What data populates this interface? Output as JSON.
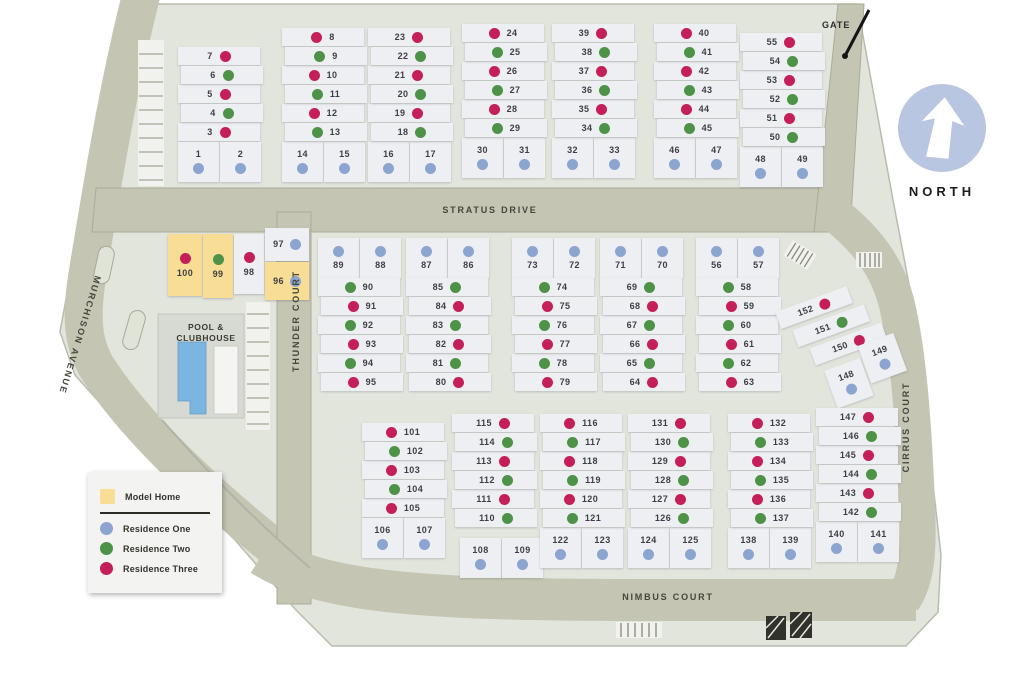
{
  "colors": {
    "1": "#8ba4d0",
    "2": "#4e9247",
    "3": "#c51f5a",
    "model": "#f8dd94",
    "road": "#c5c5b3",
    "map_bg": "#e2e5dc",
    "lot_bg": "#edeff2",
    "pool_water": "#7cb6e0",
    "north_badge": "#b9c6e1"
  },
  "labels": {
    "north": "NORTH",
    "gate": "GATE",
    "pool_line1": "POOL &",
    "pool_line2": "CLUBHOUSE"
  },
  "streets": {
    "stratus": "STRATUS DRIVE",
    "thunder": "THUNDER COURT",
    "murchison": "MURCHISON AVENUE",
    "nimbus": "NIMBUS COURT",
    "cirrus": "CIRRUS COURT"
  },
  "legend": {
    "model_home": "Model Home",
    "residence_one": "Residence One",
    "residence_two": "Residence Two",
    "residence_three": "Residence Three"
  },
  "clusters": [
    {
      "kind": "stack",
      "x": 178,
      "y": 47,
      "dot": "right",
      "pair_pos": "bottom",
      "rows": [
        [
          "7",
          "3"
        ],
        [
          "6",
          "2"
        ],
        [
          "5",
          "3"
        ],
        [
          "4",
          "2"
        ],
        [
          "3",
          "3"
        ]
      ],
      "pair": [
        [
          "1",
          "1"
        ],
        [
          "2",
          "1"
        ]
      ]
    },
    {
      "kind": "stack",
      "x": 282,
      "y": 28,
      "dot": "left",
      "pair_pos": "bottom",
      "rows": [
        [
          "8",
          "3"
        ],
        [
          "9",
          "2"
        ],
        [
          "10",
          "3"
        ],
        [
          "11",
          "2"
        ],
        [
          "12",
          "3"
        ],
        [
          "13",
          "2"
        ]
      ],
      "pair": [
        [
          "14",
          "1"
        ],
        [
          "15",
          "1"
        ]
      ]
    },
    {
      "kind": "stack",
      "x": 368,
      "y": 28,
      "dot": "right",
      "pair_pos": "bottom",
      "rows": [
        [
          "23",
          "3"
        ],
        [
          "22",
          "2"
        ],
        [
          "21",
          "3"
        ],
        [
          "20",
          "2"
        ],
        [
          "19",
          "3"
        ],
        [
          "18",
          "2"
        ]
      ],
      "pair": [
        [
          "16",
          "1"
        ],
        [
          "17",
          "1"
        ]
      ]
    },
    {
      "kind": "stack",
      "x": 462,
      "y": 24,
      "dot": "left",
      "pair_pos": "bottom",
      "rows": [
        [
          "24",
          "3"
        ],
        [
          "25",
          "2"
        ],
        [
          "26",
          "3"
        ],
        [
          "27",
          "2"
        ],
        [
          "28",
          "3"
        ],
        [
          "29",
          "2"
        ]
      ],
      "pair": [
        [
          "30",
          "1"
        ],
        [
          "31",
          "1"
        ]
      ]
    },
    {
      "kind": "stack",
      "x": 552,
      "y": 24,
      "dot": "right",
      "pair_pos": "bottom",
      "rows": [
        [
          "39",
          "3"
        ],
        [
          "38",
          "2"
        ],
        [
          "37",
          "3"
        ],
        [
          "36",
          "2"
        ],
        [
          "35",
          "3"
        ],
        [
          "34",
          "2"
        ]
      ],
      "pair": [
        [
          "32",
          "1"
        ],
        [
          "33",
          "1"
        ]
      ]
    },
    {
      "kind": "stack",
      "x": 654,
      "y": 24,
      "dot": "left",
      "pair_pos": "bottom",
      "rows": [
        [
          "40",
          "3"
        ],
        [
          "41",
          "2"
        ],
        [
          "42",
          "3"
        ],
        [
          "43",
          "2"
        ],
        [
          "44",
          "3"
        ],
        [
          "45",
          "2"
        ]
      ],
      "pair": [
        [
          "46",
          "1"
        ],
        [
          "47",
          "1"
        ]
      ]
    },
    {
      "kind": "stack",
      "x": 740,
      "y": 33,
      "dot": "right",
      "pair_pos": "bottom",
      "rows": [
        [
          "55",
          "3"
        ],
        [
          "54",
          "2"
        ],
        [
          "53",
          "3"
        ],
        [
          "52",
          "2"
        ],
        [
          "51",
          "3"
        ],
        [
          "50",
          "2"
        ]
      ],
      "pair": [
        [
          "48",
          "1"
        ],
        [
          "49",
          "1"
        ]
      ]
    },
    {
      "kind": "model",
      "x": 168,
      "y": 228,
      "cells": [
        [
          "100",
          "3",
          true
        ],
        [
          "99",
          "2",
          true
        ],
        [
          "98",
          "3",
          false
        ],
        [
          "97",
          "1",
          false
        ],
        [
          "96",
          "1",
          true
        ]
      ]
    },
    {
      "kind": "stack",
      "x": 318,
      "y": 238,
      "dot": "left",
      "pair_pos": "top",
      "rows": [
        [
          "90",
          "2"
        ],
        [
          "91",
          "3"
        ],
        [
          "92",
          "2"
        ],
        [
          "93",
          "3"
        ],
        [
          "94",
          "2"
        ],
        [
          "95",
          "3"
        ]
      ],
      "pair": [
        [
          "89",
          "1"
        ],
        [
          "88",
          "1"
        ]
      ]
    },
    {
      "kind": "stack",
      "x": 406,
      "y": 238,
      "dot": "right",
      "pair_pos": "top",
      "rows": [
        [
          "85",
          "2"
        ],
        [
          "84",
          "3"
        ],
        [
          "83",
          "2"
        ],
        [
          "82",
          "3"
        ],
        [
          "81",
          "2"
        ],
        [
          "80",
          "3"
        ]
      ],
      "pair": [
        [
          "87",
          "1"
        ],
        [
          "86",
          "1"
        ]
      ]
    },
    {
      "kind": "stack",
      "x": 512,
      "y": 238,
      "dot": "left",
      "pair_pos": "top",
      "rows": [
        [
          "74",
          "2"
        ],
        [
          "75",
          "3"
        ],
        [
          "76",
          "2"
        ],
        [
          "77",
          "3"
        ],
        [
          "78",
          "2"
        ],
        [
          "79",
          "3"
        ]
      ],
      "pair": [
        [
          "73",
          "1"
        ],
        [
          "72",
          "1"
        ]
      ]
    },
    {
      "kind": "stack",
      "x": 600,
      "y": 238,
      "dot": "right",
      "pair_pos": "top",
      "rows": [
        [
          "69",
          "2"
        ],
        [
          "68",
          "3"
        ],
        [
          "67",
          "2"
        ],
        [
          "66",
          "3"
        ],
        [
          "65",
          "2"
        ],
        [
          "64",
          "3"
        ]
      ],
      "pair": [
        [
          "71",
          "1"
        ],
        [
          "70",
          "1"
        ]
      ]
    },
    {
      "kind": "stack",
      "x": 696,
      "y": 238,
      "dot": "left",
      "pair_pos": "top",
      "rows": [
        [
          "58",
          "2"
        ],
        [
          "59",
          "3"
        ],
        [
          "60",
          "2"
        ],
        [
          "61",
          "3"
        ],
        [
          "62",
          "2"
        ],
        [
          "63",
          "3"
        ]
      ],
      "pair": [
        [
          "56",
          "1"
        ],
        [
          "57",
          "1"
        ]
      ]
    },
    {
      "kind": "diag",
      "x": 792,
      "y": 288,
      "rot": -20,
      "rows": [
        [
          "152",
          "3"
        ],
        [
          "151",
          "2"
        ],
        [
          "150",
          "3"
        ]
      ],
      "pair": [
        [
          "148",
          "1"
        ],
        [
          "149",
          "1"
        ]
      ]
    },
    {
      "kind": "stack",
      "x": 362,
      "y": 423,
      "dot": "left",
      "pair_pos": "bottom",
      "rows": [
        [
          "101",
          "3"
        ],
        [
          "102",
          "2"
        ],
        [
          "103",
          "3"
        ],
        [
          "104",
          "2"
        ],
        [
          "105",
          "3"
        ]
      ],
      "pair": [
        [
          "106",
          "1"
        ],
        [
          "107",
          "1"
        ]
      ]
    },
    {
      "kind": "stack",
      "x": 452,
      "y": 414,
      "dot": "right",
      "pair_pos": "bottom",
      "rows": [
        [
          "115",
          "3"
        ],
        [
          "114",
          "2"
        ],
        [
          "113",
          "3"
        ],
        [
          "112",
          "2"
        ],
        [
          "111",
          "3"
        ],
        [
          "110",
          "2"
        ]
      ],
      "pair": [
        [
          "108",
          "1"
        ],
        [
          "109",
          "1"
        ]
      ],
      "pair_off": [
        8,
        10
      ]
    },
    {
      "kind": "stack",
      "x": 540,
      "y": 414,
      "dot": "left",
      "pair_pos": "bottom",
      "rows": [
        [
          "116",
          "3"
        ],
        [
          "117",
          "2"
        ],
        [
          "118",
          "3"
        ],
        [
          "119",
          "2"
        ],
        [
          "120",
          "3"
        ],
        [
          "121",
          "2"
        ]
      ],
      "pair": [
        [
          "122",
          "1"
        ],
        [
          "123",
          "1"
        ]
      ]
    },
    {
      "kind": "stack",
      "x": 628,
      "y": 414,
      "dot": "right",
      "pair_pos": "bottom",
      "rows": [
        [
          "131",
          "3"
        ],
        [
          "130",
          "2"
        ],
        [
          "129",
          "3"
        ],
        [
          "128",
          "2"
        ],
        [
          "127",
          "3"
        ],
        [
          "126",
          "2"
        ]
      ],
      "pair": [
        [
          "124",
          "1"
        ],
        [
          "125",
          "1"
        ]
      ]
    },
    {
      "kind": "stack",
      "x": 728,
      "y": 414,
      "dot": "left",
      "pair_pos": "bottom",
      "rows": [
        [
          "132",
          "3"
        ],
        [
          "133",
          "2"
        ],
        [
          "134",
          "3"
        ],
        [
          "135",
          "2"
        ],
        [
          "136",
          "3"
        ],
        [
          "137",
          "2"
        ]
      ],
      "pair": [
        [
          "138",
          "1"
        ],
        [
          "139",
          "1"
        ]
      ]
    },
    {
      "kind": "stack",
      "x": 816,
      "y": 408,
      "dot": "right",
      "pair_pos": "bottom",
      "rows": [
        [
          "147",
          "3"
        ],
        [
          "146",
          "2"
        ],
        [
          "145",
          "3"
        ],
        [
          "144",
          "2"
        ],
        [
          "143",
          "3"
        ],
        [
          "142",
          "2"
        ]
      ],
      "pair": [
        [
          "140",
          "1"
        ],
        [
          "141",
          "1"
        ]
      ]
    }
  ]
}
